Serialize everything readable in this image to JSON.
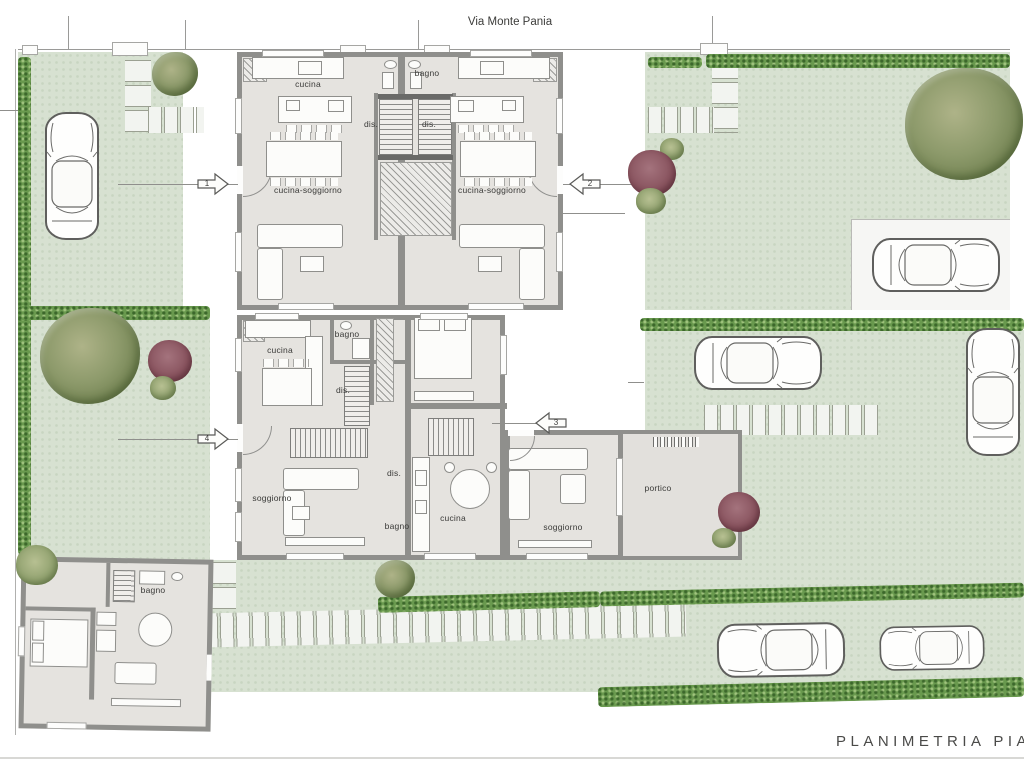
{
  "plan": {
    "street_name": "Via Monte Pania",
    "sheet_title": "Planimetria Piano"
  },
  "entrances": {
    "e1": "1",
    "e2": "2",
    "e3": "3",
    "e4": "4"
  },
  "rooms": {
    "unit1": {
      "cucina": "cucina",
      "dis": "dis.",
      "cucina_soggiorno": "cucina-soggiorno"
    },
    "unit2": {
      "bagno": "bagno",
      "dis": "dis.",
      "cucina_soggiorno": "cucina-soggiorno"
    },
    "unit3": {
      "dis": "dis.",
      "bagno": "bagno",
      "cucina": "cucina",
      "soggiorno": "soggiorno",
      "portico": "portico"
    },
    "unit4": {
      "cucina": "cucina",
      "bagno": "bagno",
      "dis": "dis.",
      "soggiorno": "soggiorno"
    },
    "unit5": {
      "bagno": "bagno"
    }
  },
  "colors": {
    "garden": "#d7e1d1",
    "hedge": "#69994e",
    "building_fill": "#e5e3df",
    "wall": "#8f8f8c",
    "shrub_accent": "#8a5560",
    "tree": "#8d9a6b"
  }
}
